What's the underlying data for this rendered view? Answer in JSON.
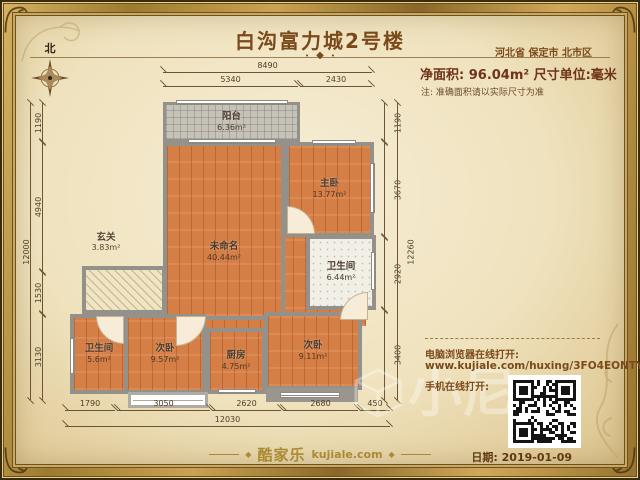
{
  "header": {
    "title": "白沟富力城2号楼",
    "location": "河北省 保定市 北市区",
    "area_line": "净面积: 96.04m²  尺寸单位:毫米",
    "note": "注: 准确面积请以实际尺寸为准",
    "compass_label": "北"
  },
  "rooms": [
    {
      "name": "阳台",
      "area": "6.36m²"
    },
    {
      "name": "主卧",
      "area": "13.77m²"
    },
    {
      "name": "未命名",
      "area": "40.44m²"
    },
    {
      "name": "玄关",
      "area": "3.83m²"
    },
    {
      "name": "卫生间",
      "area": "6.44m²"
    },
    {
      "name": "卫生间",
      "area": "5.6m²"
    },
    {
      "name": "次卧",
      "area": "9.57m²"
    },
    {
      "name": "厨房",
      "area": "4.75m²"
    },
    {
      "name": "次卧",
      "area": "9.11m²"
    }
  ],
  "dimensions": {
    "top": {
      "overall": "8490",
      "segments": [
        "5340",
        "2430"
      ]
    },
    "bottom": {
      "overall": "12030",
      "segments": [
        "1790",
        "3050",
        "2620",
        "2680",
        "450"
      ]
    },
    "left": {
      "overall": "12000",
      "segments": [
        "1190",
        "4940",
        "1530",
        "3130"
      ]
    },
    "right": {
      "overall": "12260",
      "segments": [
        "1190",
        "3670",
        "2920",
        "3400"
      ]
    }
  },
  "share": {
    "desktop_label": "电脑浏览器在线打开:",
    "url": "www.kujiale.com/huxing/3FO4EONTYVUX",
    "mobile_label": "手机在线打开:",
    "qr_icon": "qr-code"
  },
  "footer": {
    "brand": "酷家乐",
    "brand_domain": "kujiale.com",
    "date_label": "日期: 2019-01-09"
  },
  "watermark": "小尼",
  "icons": {
    "compass": "compass-rose",
    "ornament": "diamond",
    "corner": "baroque-flourish"
  },
  "colors": {
    "frame_gold": "#b8923b",
    "parchment": "#f2e7c9",
    "wood_floor": "#d57e45",
    "wall_gray": "#94908a",
    "title_brown": "#7b4a1b",
    "area_text": "#6e3318",
    "dim_line": "#6b5536"
  }
}
